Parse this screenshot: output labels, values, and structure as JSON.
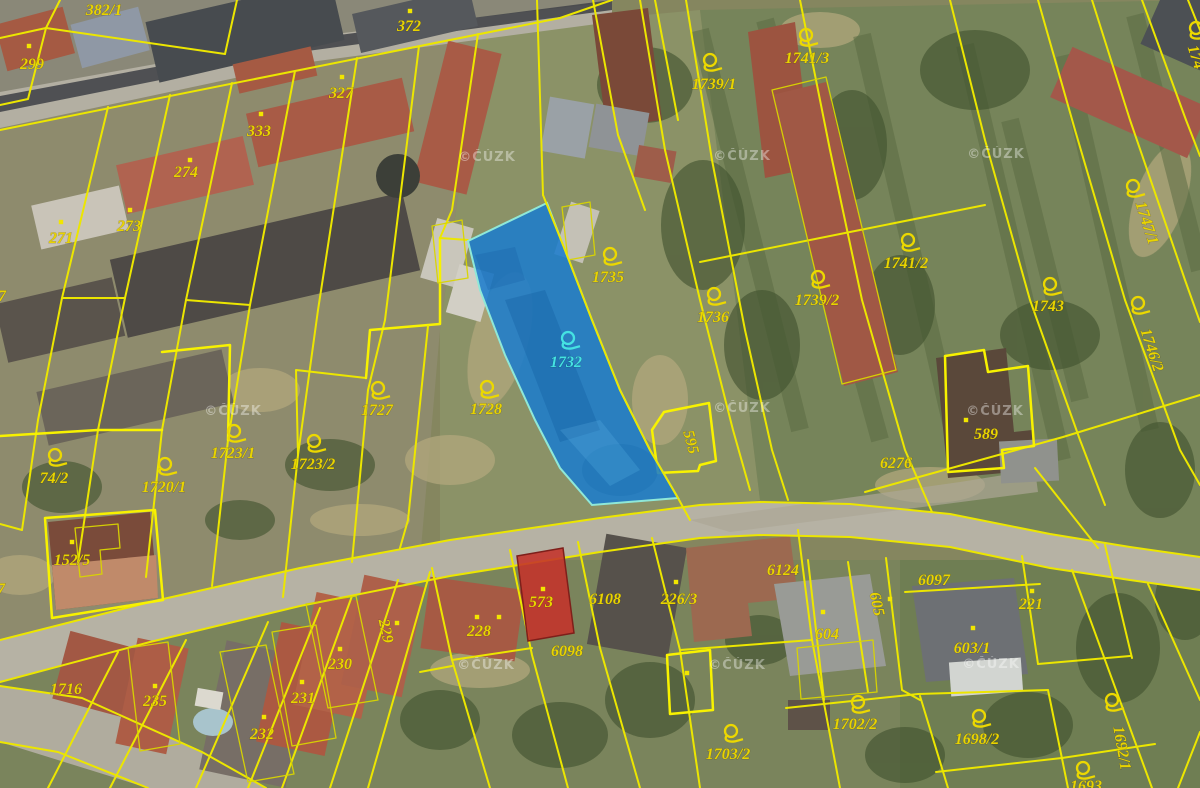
{
  "app": {
    "type": "cadastral-map-aerial-view",
    "attribution_watermark": "©ČÚZK"
  },
  "map": {
    "style": {
      "parcel_line_color": "#ece600",
      "parcel_label_color": "#e9d400",
      "highlight_fill": "#1b7ccc",
      "highlight_label_color": "#45e2e2",
      "red_parcel_fill": "#c4322a"
    },
    "highlighted_parcel": {
      "label": "1732"
    },
    "red_filled_parcel": {
      "label": "573"
    },
    "watermarks": [
      {
        "x": 487,
        "y": 157
      },
      {
        "x": 742,
        "y": 156
      },
      {
        "x": 996,
        "y": 154
      },
      {
        "x": 233,
        "y": 411
      },
      {
        "x": 742,
        "y": 408
      },
      {
        "x": 995,
        "y": 411
      },
      {
        "x": 486,
        "y": 665
      },
      {
        "x": 737,
        "y": 665
      },
      {
        "x": 991,
        "y": 664
      }
    ],
    "extra_points": [
      [
        499,
        617
      ],
      [
        687,
        673
      ]
    ],
    "parcels": [
      {
        "label": "382/1",
        "x": 104,
        "y": 10
      },
      {
        "label": "299",
        "x": 32,
        "y": 64,
        "dot": {
          "x": 29,
          "y": 46
        }
      },
      {
        "label": "327",
        "x": 341,
        "y": 93,
        "dot": {
          "x": 342,
          "y": 77
        }
      },
      {
        "label": "333",
        "x": 259,
        "y": 131,
        "dot": {
          "x": 261,
          "y": 114
        }
      },
      {
        "label": "274",
        "x": 186,
        "y": 172,
        "dot": {
          "x": 190,
          "y": 160
        }
      },
      {
        "label": "273",
        "x": 129,
        "y": 226,
        "dot": {
          "x": 130,
          "y": 210
        }
      },
      {
        "label": "271",
        "x": 61,
        "y": 238,
        "dot": {
          "x": 61,
          "y": 222
        }
      },
      {
        "label": "372",
        "x": 409,
        "y": 26,
        "dot": {
          "x": 410,
          "y": 11
        }
      },
      {
        "label": "1739/1",
        "x": 714,
        "y": 84,
        "pin": {
          "x": 710,
          "y": 60
        }
      },
      {
        "label": "1741/3",
        "x": 807,
        "y": 58,
        "pin": {
          "x": 806,
          "y": 35
        }
      },
      {
        "label": "1735",
        "x": 608,
        "y": 277,
        "pin": {
          "x": 610,
          "y": 254
        }
      },
      {
        "label": "1736",
        "x": 713,
        "y": 317,
        "pin": {
          "x": 714,
          "y": 294
        }
      },
      {
        "label": "1732",
        "x": 566,
        "y": 362,
        "color": "cyan",
        "pin": {
          "x": 568,
          "y": 338
        }
      },
      {
        "label": "1727",
        "x": 377,
        "y": 410,
        "pin": {
          "x": 378,
          "y": 388
        }
      },
      {
        "label": "1728",
        "x": 486,
        "y": 409,
        "pin": {
          "x": 487,
          "y": 387
        }
      },
      {
        "label": "1723/1",
        "x": 233,
        "y": 453,
        "pin": {
          "x": 234,
          "y": 431
        }
      },
      {
        "label": "1723/2",
        "x": 313,
        "y": 464,
        "pin": {
          "x": 314,
          "y": 441
        }
      },
      {
        "label": "1720/1",
        "x": 164,
        "y": 487,
        "pin": {
          "x": 165,
          "y": 464
        }
      },
      {
        "label": "74/2",
        "x": 54,
        "y": 478,
        "pin": {
          "x": 55,
          "y": 455
        }
      },
      {
        "label": "1739/2",
        "x": 817,
        "y": 300,
        "pin": {
          "x": 818,
          "y": 277
        }
      },
      {
        "label": "1741/2",
        "x": 906,
        "y": 263,
        "pin": {
          "x": 908,
          "y": 240
        }
      },
      {
        "label": "1743",
        "x": 1048,
        "y": 306,
        "pin": {
          "x": 1050,
          "y": 284
        }
      },
      {
        "label": "1746/2",
        "x": 1152,
        "y": 350,
        "rot": 72,
        "pin": {
          "x": 1138,
          "y": 303
        }
      },
      {
        "label": "1747/1",
        "x": 1147,
        "y": 223,
        "rot": 72,
        "pin": {
          "x": 1133,
          "y": 186
        }
      },
      {
        "label": "174",
        "x": 1196,
        "y": 57,
        "rot": 72,
        "pin": {
          "x": 1196,
          "y": 28
        }
      },
      {
        "label": "589",
        "x": 986,
        "y": 434,
        "dot": {
          "x": 966,
          "y": 420
        }
      },
      {
        "label": "6276",
        "x": 896,
        "y": 463
      },
      {
        "label": "595",
        "x": 691,
        "y": 442,
        "rot": 75
      },
      {
        "label": "152/5",
        "x": 72,
        "y": 560,
        "dot": {
          "x": 72,
          "y": 542
        }
      },
      {
        "label": "1716",
        "x": 66,
        "y": 689
      },
      {
        "label": "235",
        "x": 155,
        "y": 701,
        "dot": {
          "x": 155,
          "y": 686
        }
      },
      {
        "label": "232",
        "x": 262,
        "y": 734,
        "dot": {
          "x": 264,
          "y": 717
        }
      },
      {
        "label": "231",
        "x": 303,
        "y": 698,
        "dot": {
          "x": 302,
          "y": 682
        }
      },
      {
        "label": "230",
        "x": 340,
        "y": 664,
        "dot": {
          "x": 340,
          "y": 649
        }
      },
      {
        "label": "229",
        "x": 386,
        "y": 631,
        "rot": 78,
        "dot": {
          "x": 397,
          "y": 623
        }
      },
      {
        "label": "228",
        "x": 479,
        "y": 631,
        "dot": {
          "x": 477,
          "y": 617
        }
      },
      {
        "label": "573",
        "x": 541,
        "y": 602,
        "dot": {
          "x": 543,
          "y": 589
        }
      },
      {
        "label": "6108",
        "x": 605,
        "y": 599
      },
      {
        "label": "226/3",
        "x": 679,
        "y": 599,
        "dot": {
          "x": 676,
          "y": 582
        }
      },
      {
        "label": "6098",
        "x": 567,
        "y": 651
      },
      {
        "label": "6124",
        "x": 783,
        "y": 570
      },
      {
        "label": "604",
        "x": 827,
        "y": 634,
        "dot": {
          "x": 823,
          "y": 612
        }
      },
      {
        "label": "605",
        "x": 877,
        "y": 604,
        "rot": 78,
        "dot": {
          "x": 890,
          "y": 599
        }
      },
      {
        "label": "6097",
        "x": 934,
        "y": 580
      },
      {
        "label": "221",
        "x": 1031,
        "y": 604,
        "dot": {
          "x": 1032,
          "y": 591
        }
      },
      {
        "label": "603/1",
        "x": 972,
        "y": 648,
        "dot": {
          "x": 973,
          "y": 628
        }
      },
      {
        "label": "1702/2",
        "x": 855,
        "y": 724,
        "pin": {
          "x": 858,
          "y": 702
        }
      },
      {
        "label": "1703/2",
        "x": 728,
        "y": 754,
        "pin": {
          "x": 731,
          "y": 731
        }
      },
      {
        "label": "1698/2",
        "x": 977,
        "y": 739,
        "pin": {
          "x": 979,
          "y": 716
        }
      },
      {
        "label": "1692/1",
        "x": 1122,
        "y": 748,
        "rot": 80,
        "pin": {
          "x": 1112,
          "y": 700
        }
      },
      {
        "label": "1693",
        "x": 1086,
        "y": 786,
        "pin": {
          "x": 1083,
          "y": 768
        }
      },
      {
        "label": "7",
        "x": 2,
        "y": 296
      },
      {
        "label": "7",
        "x": 1,
        "y": 589
      }
    ]
  }
}
